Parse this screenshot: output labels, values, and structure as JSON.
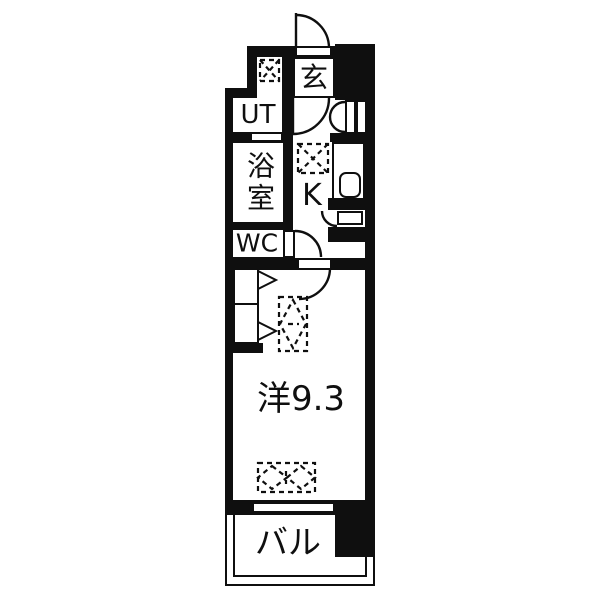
{
  "floor_plan": {
    "kind": "apartment-floor-plan",
    "rooms": {
      "entrance": "玄",
      "utility": "UT",
      "bathroom": "浴室",
      "toilet": "WC",
      "kitchen": "K",
      "main_room": "洋9.3",
      "balcony": "バル"
    },
    "main_room_area_tatami": "9.3",
    "colors": {
      "wall": "#0f0f0f",
      "floor": "#ffffff",
      "background": "#ffffff"
    },
    "icons": [
      "entrance-door-arc",
      "hall-door-arc",
      "shoe-cabinet-double-door-icon",
      "wc-door-arc",
      "room-door-arc",
      "storage-hatch-arc",
      "closet-folding-door-icon",
      "washing-machine-space-icon",
      "refrigerator-space-icon",
      "furniture-space-vertical-icon",
      "furniture-space-horizontal-icon",
      "sink-icon",
      "window-sash",
      "balcony-railing"
    ]
  }
}
